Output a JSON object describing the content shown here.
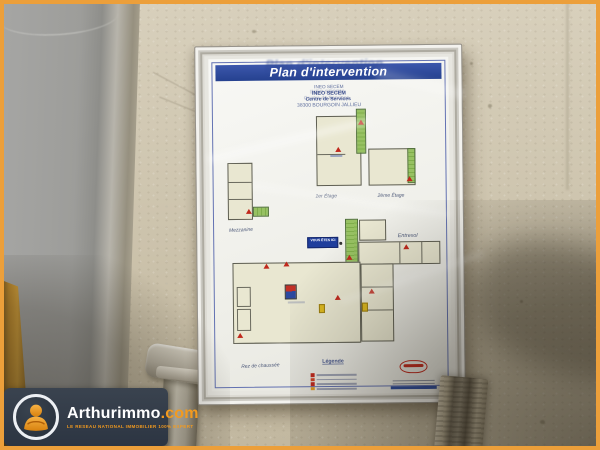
{
  "photo": {
    "border_color": "#EC9F3A",
    "watermark": {
      "brand": "Arthurimmo",
      "suffix": ".com",
      "tagline": "LE RESEAU NATIONAL IMMOBILIER 100% EXPERT",
      "badge_color": "#323C4A",
      "accent_color": "#F29A1F"
    },
    "plan": {
      "title": "Plan d'intervention",
      "address": [
        "INEO SECEM",
        "INEO SECEM",
        "Centre de Services",
        "38300 BOURGOIN JALLIEU"
      ],
      "labels": {
        "mezzanine": "Mezzanine",
        "first_floor": "1er Étage",
        "second_floor": "2ème Étage",
        "entresol": "Entresol",
        "ground_floor": "Rez de chaussée"
      },
      "you_are_here": "VOUS ÊTES ICI",
      "legend_title": "Légende",
      "legend_icon_colors": [
        "#c0281c",
        "#d04428",
        "#c0281c",
        "#e09a22",
        "#55982e",
        "#2b4a9e"
      ],
      "colors": {
        "banner_blue": "#2E4A9E",
        "stair_green": "#8FBE5E",
        "marker_red": "#C0281C",
        "room_fill": "#E9E7D1",
        "supplier_logo_red": "#C0281C"
      }
    }
  }
}
